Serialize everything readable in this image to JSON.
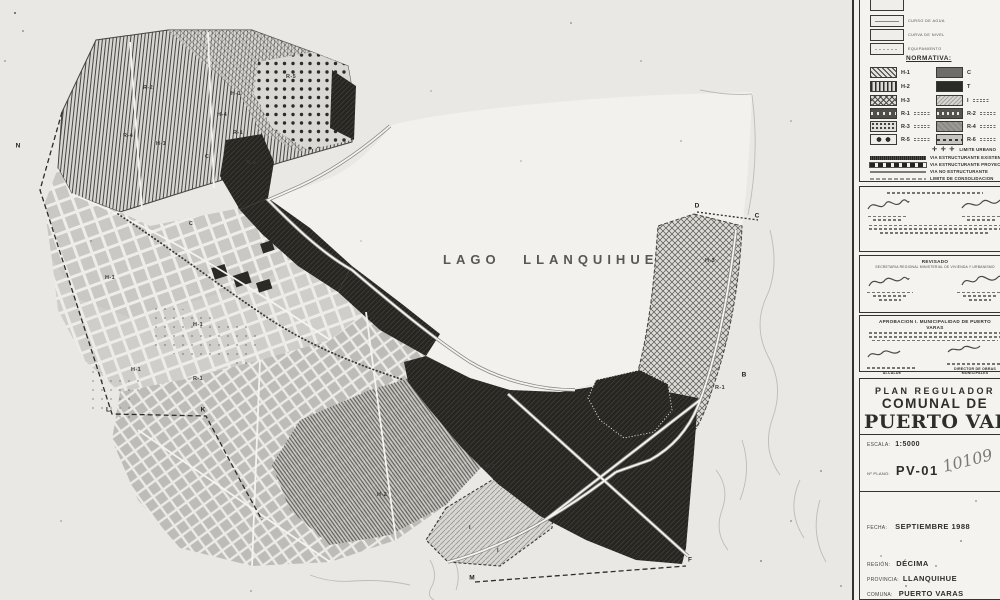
{
  "colors": {
    "paper": "#e9e8e5",
    "panel": "#f3f2ef",
    "ink": "#2e2e29",
    "dark_zone": "#26251f"
  },
  "map": {
    "lake_label": "LAGO LLANQUIHUE",
    "zone_labels": [
      {
        "text": "R-2",
        "x": 148,
        "y": 88
      },
      {
        "text": "R-5",
        "x": 291,
        "y": 77
      },
      {
        "text": "H-1",
        "x": 236,
        "y": 94
      },
      {
        "text": "H-4",
        "x": 222,
        "y": 115
      },
      {
        "text": "R-4",
        "x": 128,
        "y": 136
      },
      {
        "text": "H-1",
        "x": 161,
        "y": 144
      },
      {
        "text": "R-1",
        "x": 238,
        "y": 133
      },
      {
        "text": "C",
        "x": 207,
        "y": 157
      },
      {
        "text": "R-4",
        "x": 251,
        "y": 163
      },
      {
        "text": "C",
        "x": 240,
        "y": 208
      },
      {
        "text": "C",
        "x": 191,
        "y": 224
      },
      {
        "text": "H-1",
        "x": 110,
        "y": 278
      },
      {
        "text": "H-1",
        "x": 198,
        "y": 325
      },
      {
        "text": "H-1",
        "x": 136,
        "y": 370
      },
      {
        "text": "R-1",
        "x": 198,
        "y": 379
      },
      {
        "text": "H-2",
        "x": 382,
        "y": 495
      },
      {
        "text": "H-2",
        "x": 490,
        "y": 467
      },
      {
        "text": "H-3",
        "x": 710,
        "y": 261
      },
      {
        "text": "R-1",
        "x": 720,
        "y": 388
      },
      {
        "text": "I",
        "x": 470,
        "y": 528
      },
      {
        "text": "I",
        "x": 498,
        "y": 551
      }
    ],
    "boundary_points": [
      {
        "text": "N",
        "x": 18,
        "y": 146
      },
      {
        "text": "L",
        "x": 108,
        "y": 410
      },
      {
        "text": "K",
        "x": 203,
        "y": 410
      },
      {
        "text": "M",
        "x": 472,
        "y": 578
      },
      {
        "text": "F",
        "x": 690,
        "y": 560
      },
      {
        "text": "B",
        "x": 744,
        "y": 375
      },
      {
        "text": "D",
        "x": 697,
        "y": 206
      },
      {
        "text": "C",
        "x": 757,
        "y": 216
      }
    ]
  },
  "legend": {
    "symbols": [
      {
        "label": ""
      },
      {
        "label": "CURSO DE AGUA"
      },
      {
        "label": "CURVA DE NIVEL"
      },
      {
        "label": "EQUIPAMIENTO"
      }
    ],
    "normativa_title": "NORMATIVA:",
    "normativa_left": [
      {
        "code": "H-1"
      },
      {
        "code": "H-2"
      },
      {
        "code": "H-3"
      },
      {
        "code": "R-1"
      },
      {
        "code": "R-3"
      },
      {
        "code": "R-5"
      }
    ],
    "normativa_right": [
      {
        "code": "C"
      },
      {
        "code": "T"
      },
      {
        "code": "I"
      },
      {
        "code": "R-2"
      },
      {
        "code": "R-4"
      },
      {
        "code": "R-6"
      }
    ],
    "limite_urbano_symbol": "✛ ✛ ✛",
    "limite_urbano": "LIMITE URBANO",
    "vias": [
      "VIA ESTRUCTURANTE EXISTENTE",
      "VIA ESTRUCTURANTE PROYECTADA",
      "VIA NO ESTRUCTURANTE",
      "LIMITE DE CONSOLIDACION"
    ]
  },
  "approvals": {
    "revisado_title": "REVISADO",
    "revisado_subtitle": "SECRETARIA REGIONAL MINISTERIAL DE VIVIENDA Y URBANISMO",
    "municipal_title": "APROBACION I. MUNICIPALIDAD DE PUERTO VARAS",
    "alcalde_label": "ALCALDE",
    "obras_label": "DIRECTOR DE OBRAS MUNICIPALES"
  },
  "title_block": {
    "line1": "PLAN REGULADOR",
    "line2": "COMUNAL DE",
    "line3": "PUERTO VARAS",
    "escala_label": "ESCALA:",
    "escala_value": "1:5000",
    "plano_label": "Nº PLANO:",
    "plano_value": "PV-01",
    "plano_handwritten": "10109",
    "fecha_label": "FECHA:",
    "fecha_value": "SEPTIEMBRE 1988",
    "region_label": "REGIÓN:",
    "region_value": "DÉCIMA",
    "provincia_label": "PROVINCIA:",
    "provincia_value": "LLANQUIHUE",
    "comuna_label": "COMUNA:",
    "comuna_value": "PUERTO VARAS"
  }
}
